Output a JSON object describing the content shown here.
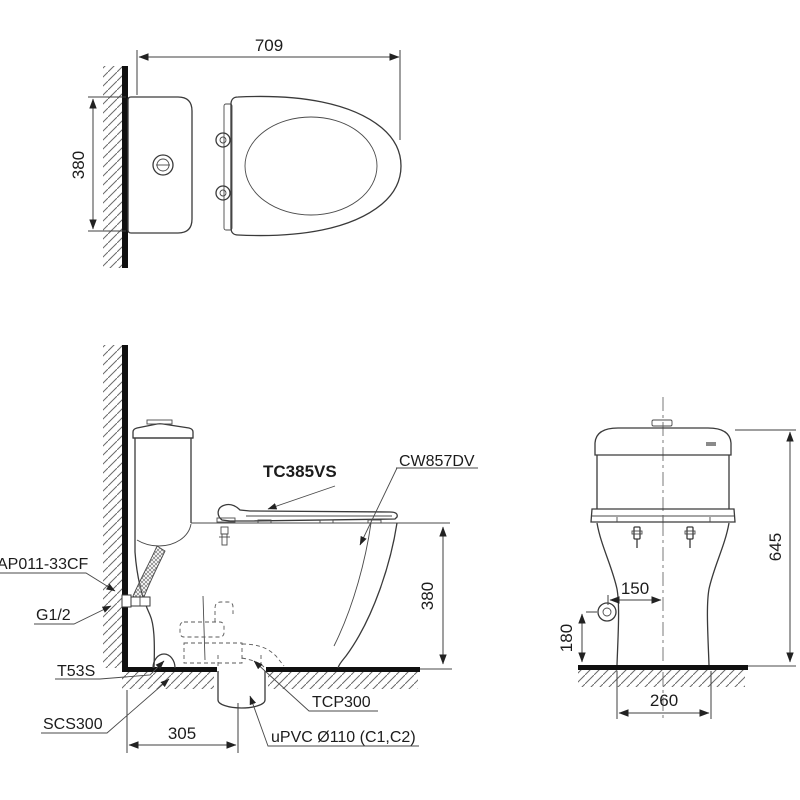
{
  "drawing": {
    "top_view": {
      "dim_width": "709",
      "dim_depth": "380"
    },
    "side_view": {
      "label_seat": "TC385VS",
      "label_bowl": "CW857DV",
      "label_valve": "AP011-33CF",
      "label_thread": "G1/2",
      "label_bolt_cap": "T53S",
      "label_flange": "SCS300",
      "label_socket": "TCP300",
      "label_pipe": "uPVC Ø110 (C1,C2)",
      "dim_rim_height": "380",
      "dim_outlet_offset": "305"
    },
    "front_view": {
      "dim_height": "645",
      "dim_inlet_offset": "150",
      "dim_inlet_height": "180",
      "dim_base_width": "260"
    }
  }
}
